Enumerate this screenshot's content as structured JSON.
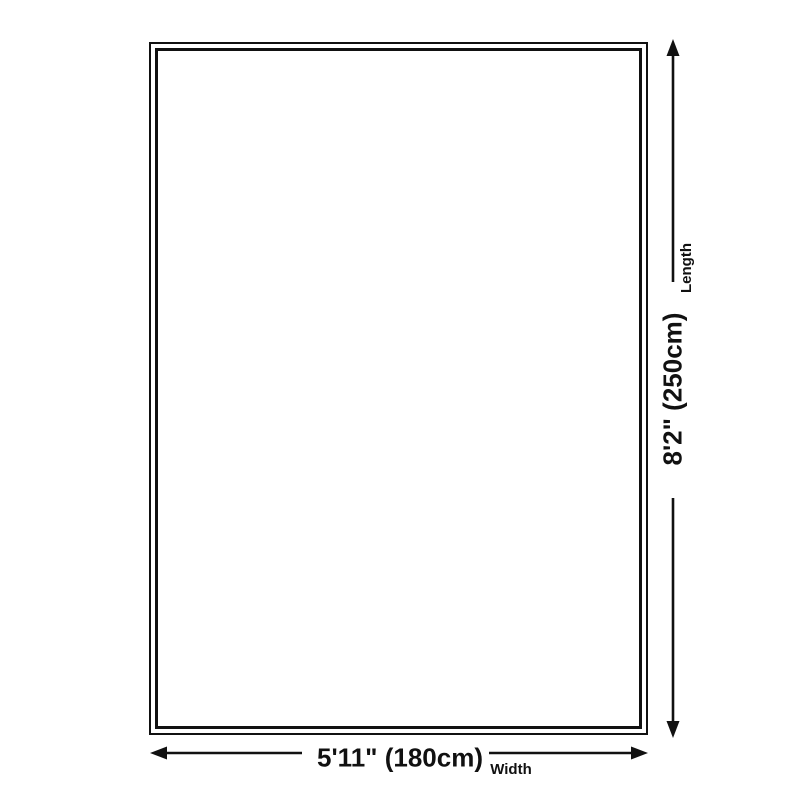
{
  "diagram": {
    "width": {
      "value": "5'11\" (180cm)",
      "label": "Width"
    },
    "length": {
      "value": "8'2\" (250cm)",
      "label": "Length"
    }
  },
  "colors": {
    "line": "#111111",
    "background": "#ffffff"
  }
}
